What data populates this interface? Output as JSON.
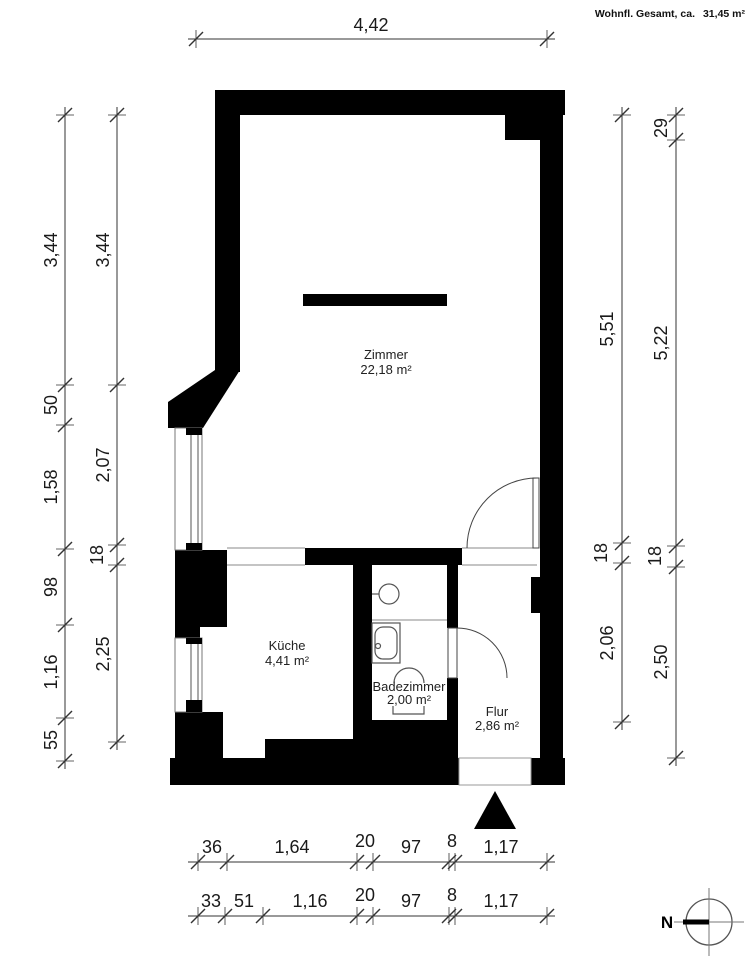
{
  "header": {
    "label": "Wohnfl. Gesamt, ca.",
    "value": "31,45 m²"
  },
  "rooms": [
    {
      "name": "Zimmer",
      "area": "22,18 m²"
    },
    {
      "name": "Küche",
      "area": "4,41 m²"
    },
    {
      "name": "Badezimmer",
      "area": "2,00 m²"
    },
    {
      "name": "Flur",
      "area": "2,86 m²"
    }
  ],
  "dimensions": {
    "top": [
      "4,42"
    ],
    "left_outer": [
      "3,44",
      "50",
      "1,58",
      "98",
      "1,16",
      "55"
    ],
    "left_inner": [
      "3,44",
      "2,07",
      "18",
      "2,25"
    ],
    "right_inner": [
      "5,51",
      "18",
      "2,06"
    ],
    "right_outer": [
      "29",
      "5,22",
      "18",
      "2,50"
    ],
    "bottom_upper": [
      "36",
      "1,64",
      "20",
      "97",
      "8",
      "1,17"
    ],
    "bottom_lower": [
      "33",
      "51",
      "1,16",
      "20",
      "97",
      "8",
      "1,17"
    ]
  },
  "compass": {
    "label": "N"
  },
  "colors": {
    "walls": "#000000",
    "background": "#ffffff",
    "lines": "#222222"
  }
}
